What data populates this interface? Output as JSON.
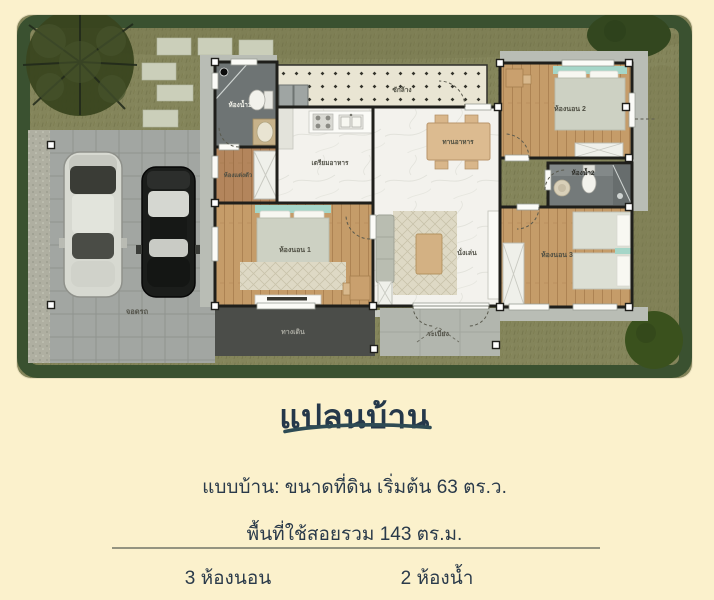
{
  "page": {
    "background": "#FBF1CC"
  },
  "plan": {
    "rooms": {
      "bathroom1": "ห้องน้ำ1",
      "dressing": "ห้องแต่งตัว",
      "laundry": "ซักล้าง",
      "kitchen": "เตรียมอาหาร",
      "dining": "ทานอาหาร",
      "living": "นั่งเล่น",
      "bedroom1": "ห้องนอน 1",
      "bedroom2": "ห้องนอน 2",
      "bedroom3": "ห้องนอน 3",
      "bathroom2": "ห้องน้ำ2",
      "walkway": "ทางเดิน",
      "terrace": "ระเบียง",
      "parking": "จอดรถ"
    }
  },
  "details": {
    "title": "แปลนบ้าน",
    "land_line": "แบบบ้าน: ขนาดที่ดิน เริ่มต้น 63 ตร.ว.",
    "area_line": "พื้นที่ใช้สอยรวม 143 ตร.ม.",
    "bedrooms_label": "3 ห้องนอน",
    "bathrooms_label": "2 ห้องน้ำ"
  },
  "colors": {
    "background": "#FBF1CC",
    "heading_text": "#25384A",
    "underline": "#2E4B54",
    "grass": "#84855B",
    "grass_border": "#3A5130",
    "wood_floor": "#C59C69",
    "bath_tile": "#6E7474",
    "wall": "#1F1F1B",
    "teal_headboard": "#A5D6C8"
  }
}
